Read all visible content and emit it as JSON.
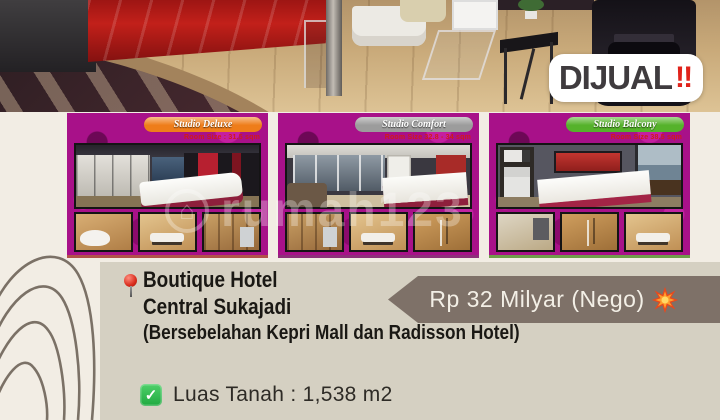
{
  "page": {
    "bg_top": "#f2ede4",
    "bg_panel": "#d5d0c2"
  },
  "sale_badge": {
    "label": "DIJUAL",
    "marks": "‼",
    "label_color": "#3f3b3e",
    "marks_color": "#e0231b"
  },
  "watermark": {
    "text": "rumah123"
  },
  "cards": [
    {
      "name": "Studio Deluxe",
      "room_size": "Room Size : 31.5 sqm",
      "banner_color": "#ee7d1a",
      "edge_color": "#b2524a"
    },
    {
      "name": "Studio Comfort",
      "room_size": "Room Size 32.8 - 34 sqm",
      "banner_color": "#9c9c9c",
      "edge_color": "#8e2f7a"
    },
    {
      "name": "Studio Balcony",
      "room_size": "Room Size 38.5 sqm",
      "banner_color": "#55b22b",
      "edge_color": "#6f9e4a"
    }
  ],
  "listing": {
    "name": "Boutique Hotel",
    "location": "Central Sukajadi",
    "note": "(Bersebelahan Kepri Mall dan Radisson Hotel)",
    "price": "Rp 32 Milyar (Nego)",
    "price_ribbon_color": "#7e7168",
    "land_area_label": "Luas Tanah : 1,538 m2"
  },
  "icons": {
    "pin": "red-pushpin",
    "check": "green-checkbox",
    "boom": "collision-spark",
    "watermark_logo": "house-in-circle"
  }
}
